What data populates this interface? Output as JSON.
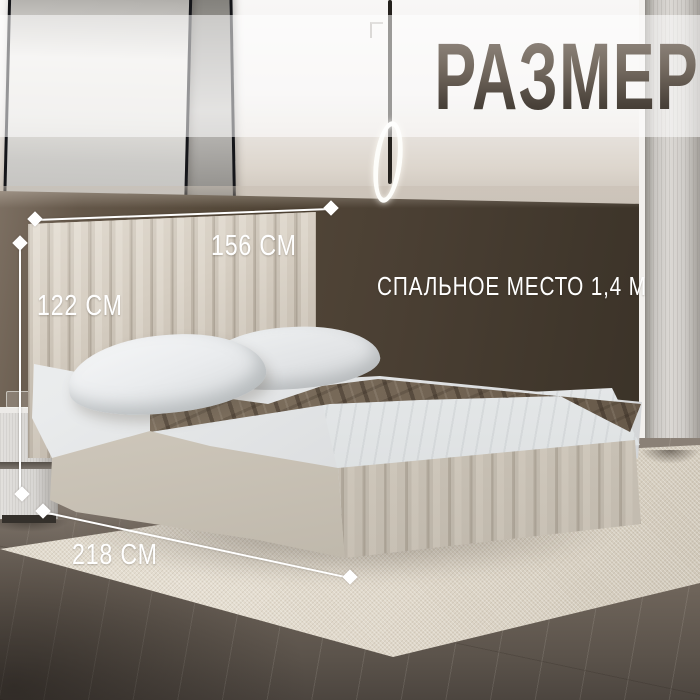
{
  "title": "РАЗМЕРЫ",
  "dimensions": {
    "width_label": "156 СМ",
    "height_label": "122 СМ",
    "length_label": "218 СМ",
    "sleeping_label": "СПАЛЬНОЕ МЕСТО 1,4 М"
  },
  "colors": {
    "annotation_white": "#ffffff",
    "title_gradient_top": "#958c83",
    "title_gradient_bottom": "#3b342d",
    "title_band": "rgba(255,255,255,0.55)",
    "wall_dark_brown": "#4a3f33",
    "wall_light": "#f1efee",
    "bed_upholstery": "#d6cec3",
    "blanket_taupe": "#7c6e5d",
    "pillow_white": "#f0f1f2",
    "rug_cream": "#ded6c8",
    "floor_wood": "#6e645a",
    "wardrobe_gray": "#cfccc8"
  }
}
